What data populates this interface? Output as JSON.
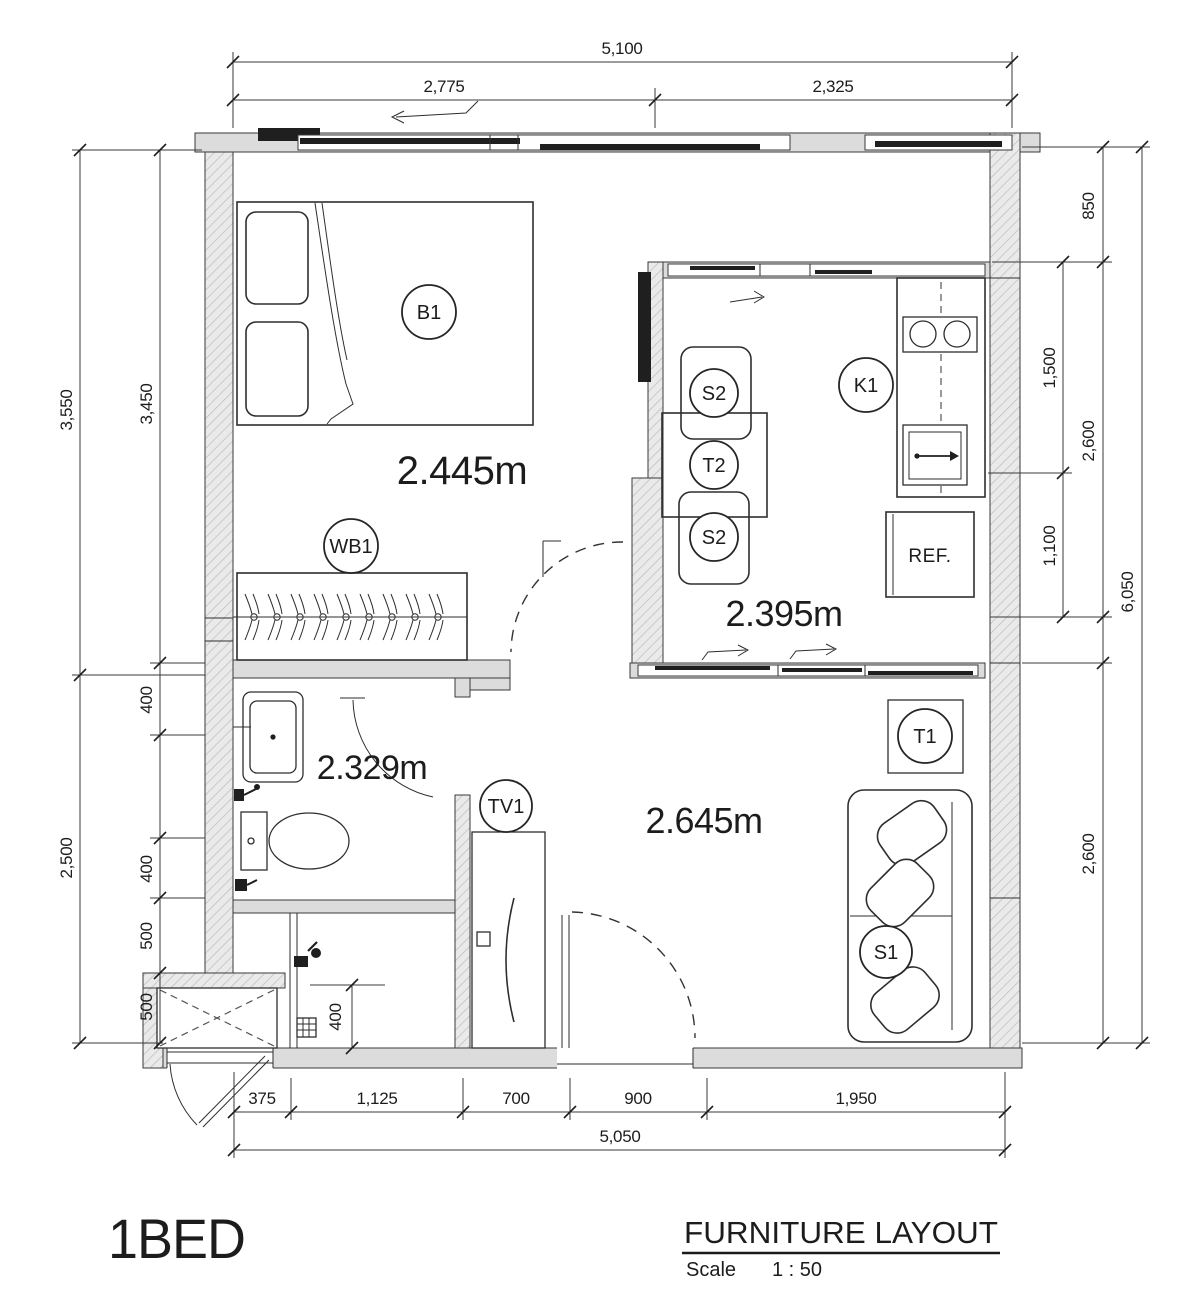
{
  "meta": {
    "accent_color": "#3d6e94",
    "line_color": "#2e2e2e"
  },
  "title_block": {
    "unit_name": "1BED",
    "drawing_title": "FURNITURE LAYOUT",
    "scale_label": "Scale",
    "scale_value": "1 : 50"
  },
  "room_labels": {
    "bedroom": "2.445m",
    "kitchen": "2.395m",
    "bathroom": "2.329m",
    "living": "2.645m"
  },
  "tags": {
    "bed": "B1",
    "wardrobe": "WB1",
    "tv": "TV1",
    "kitchen_counter": "K1",
    "fridge": "REF.",
    "dining_chair_top": "S2",
    "dining_table": "T2",
    "dining_chair_bottom": "S2",
    "side_table": "T1",
    "sofa": "S1"
  },
  "dimensions": {
    "top": {
      "total": "5,100",
      "left_segment": "2,775",
      "right_segment": "2,325"
    },
    "left": {
      "outer_upper": "3,550",
      "inner_upper": "3,450",
      "outer_lower": "2,500",
      "seg_400a": "400",
      "seg_400b": "400",
      "seg_500a": "500",
      "seg_500b": "500"
    },
    "right": {
      "top": "850",
      "mid_upper": "1,500",
      "outer_upper": "2,600",
      "mid_lower": "1,100",
      "outer_total": "6,050",
      "lower": "2,600"
    },
    "bottom": {
      "seg1": "375",
      "seg2": "1,125",
      "seg3": "700",
      "seg4": "900",
      "seg5": "1,950",
      "total": "5,050"
    },
    "interior": {
      "laundry_depth": "400"
    }
  }
}
